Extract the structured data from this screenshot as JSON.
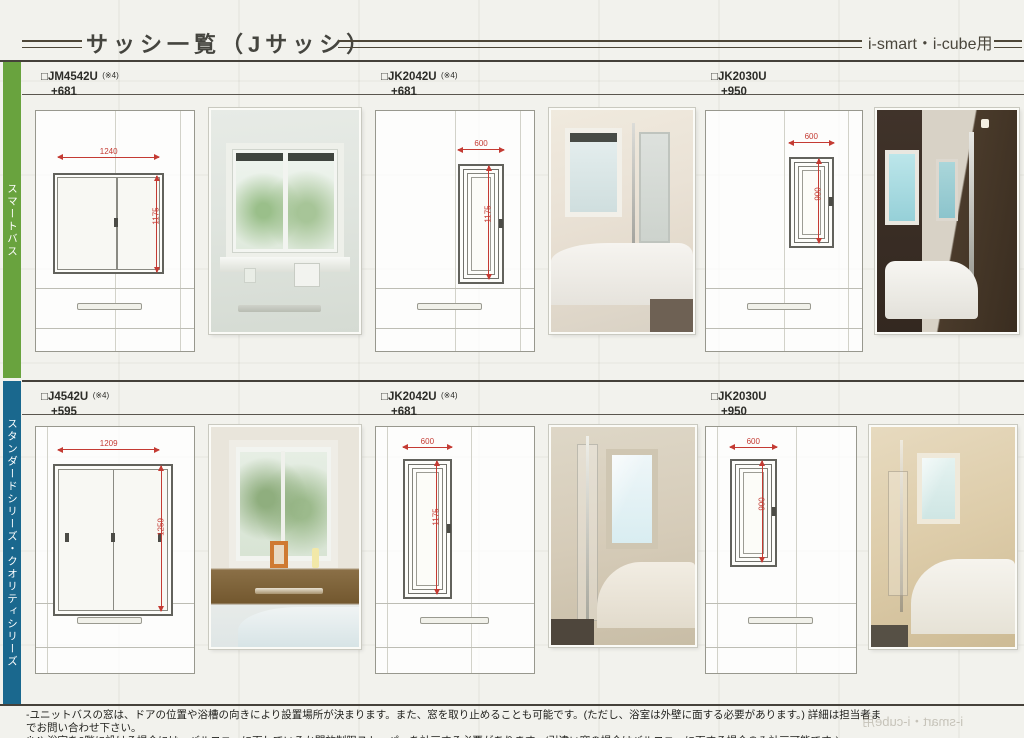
{
  "header": {
    "title": "サッシ一覧（Jサッシ）",
    "right_label": "i-smart・i-cube用"
  },
  "rows": [
    {
      "side_label": "スマートバス",
      "side_color": "#69a33e",
      "sections": [
        {
          "model": "□JM4542U",
          "note_ref": "(※4)",
          "price": "+681",
          "dim_w": "1240",
          "dim_h": "1175"
        },
        {
          "model": "□JK2042U",
          "note_ref": "(※4)",
          "price": "+681",
          "dim_w": "600",
          "dim_h": "1175"
        },
        {
          "model": "□JK2030U",
          "note_ref": "",
          "price": "+950",
          "dim_w": "600",
          "dim_h": "900"
        }
      ]
    },
    {
      "side_label": "スタンダードシリーズ・クオリティシリーズ",
      "side_color": "#1a688e",
      "sections": [
        {
          "model": "□J4542U",
          "note_ref": "(※4)",
          "price": "+595",
          "dim_w": "1209",
          "dim_h": "1259"
        },
        {
          "model": "□JK2042U",
          "note_ref": "(※4)",
          "price": "+681",
          "dim_w": "600",
          "dim_h": "1175"
        },
        {
          "model": "□JK2030U",
          "note_ref": "",
          "price": "+950",
          "dim_w": "600",
          "dim_h": "900"
        }
      ]
    }
  ],
  "footer": {
    "line1": "-ユニットバスの窓は、ドアの位置や浴槽の向きにより設置場所が決まります。また、窓を取り止めることも可能です。(ただし、浴室は外壁に面する必要があります。) 詳細は担当者までお問い合わせ下さい。",
    "line2": "※4) 浴室を2階に設ける場合には、バルコニーに面しているか開放制限ストッパーを計画する必要があります。(引違い窓の場合はバルコニーに面する場合のみ計画可能です。)",
    "bleedthrough": "i-smart・i-cube用"
  },
  "dim_color": "#c43b33"
}
